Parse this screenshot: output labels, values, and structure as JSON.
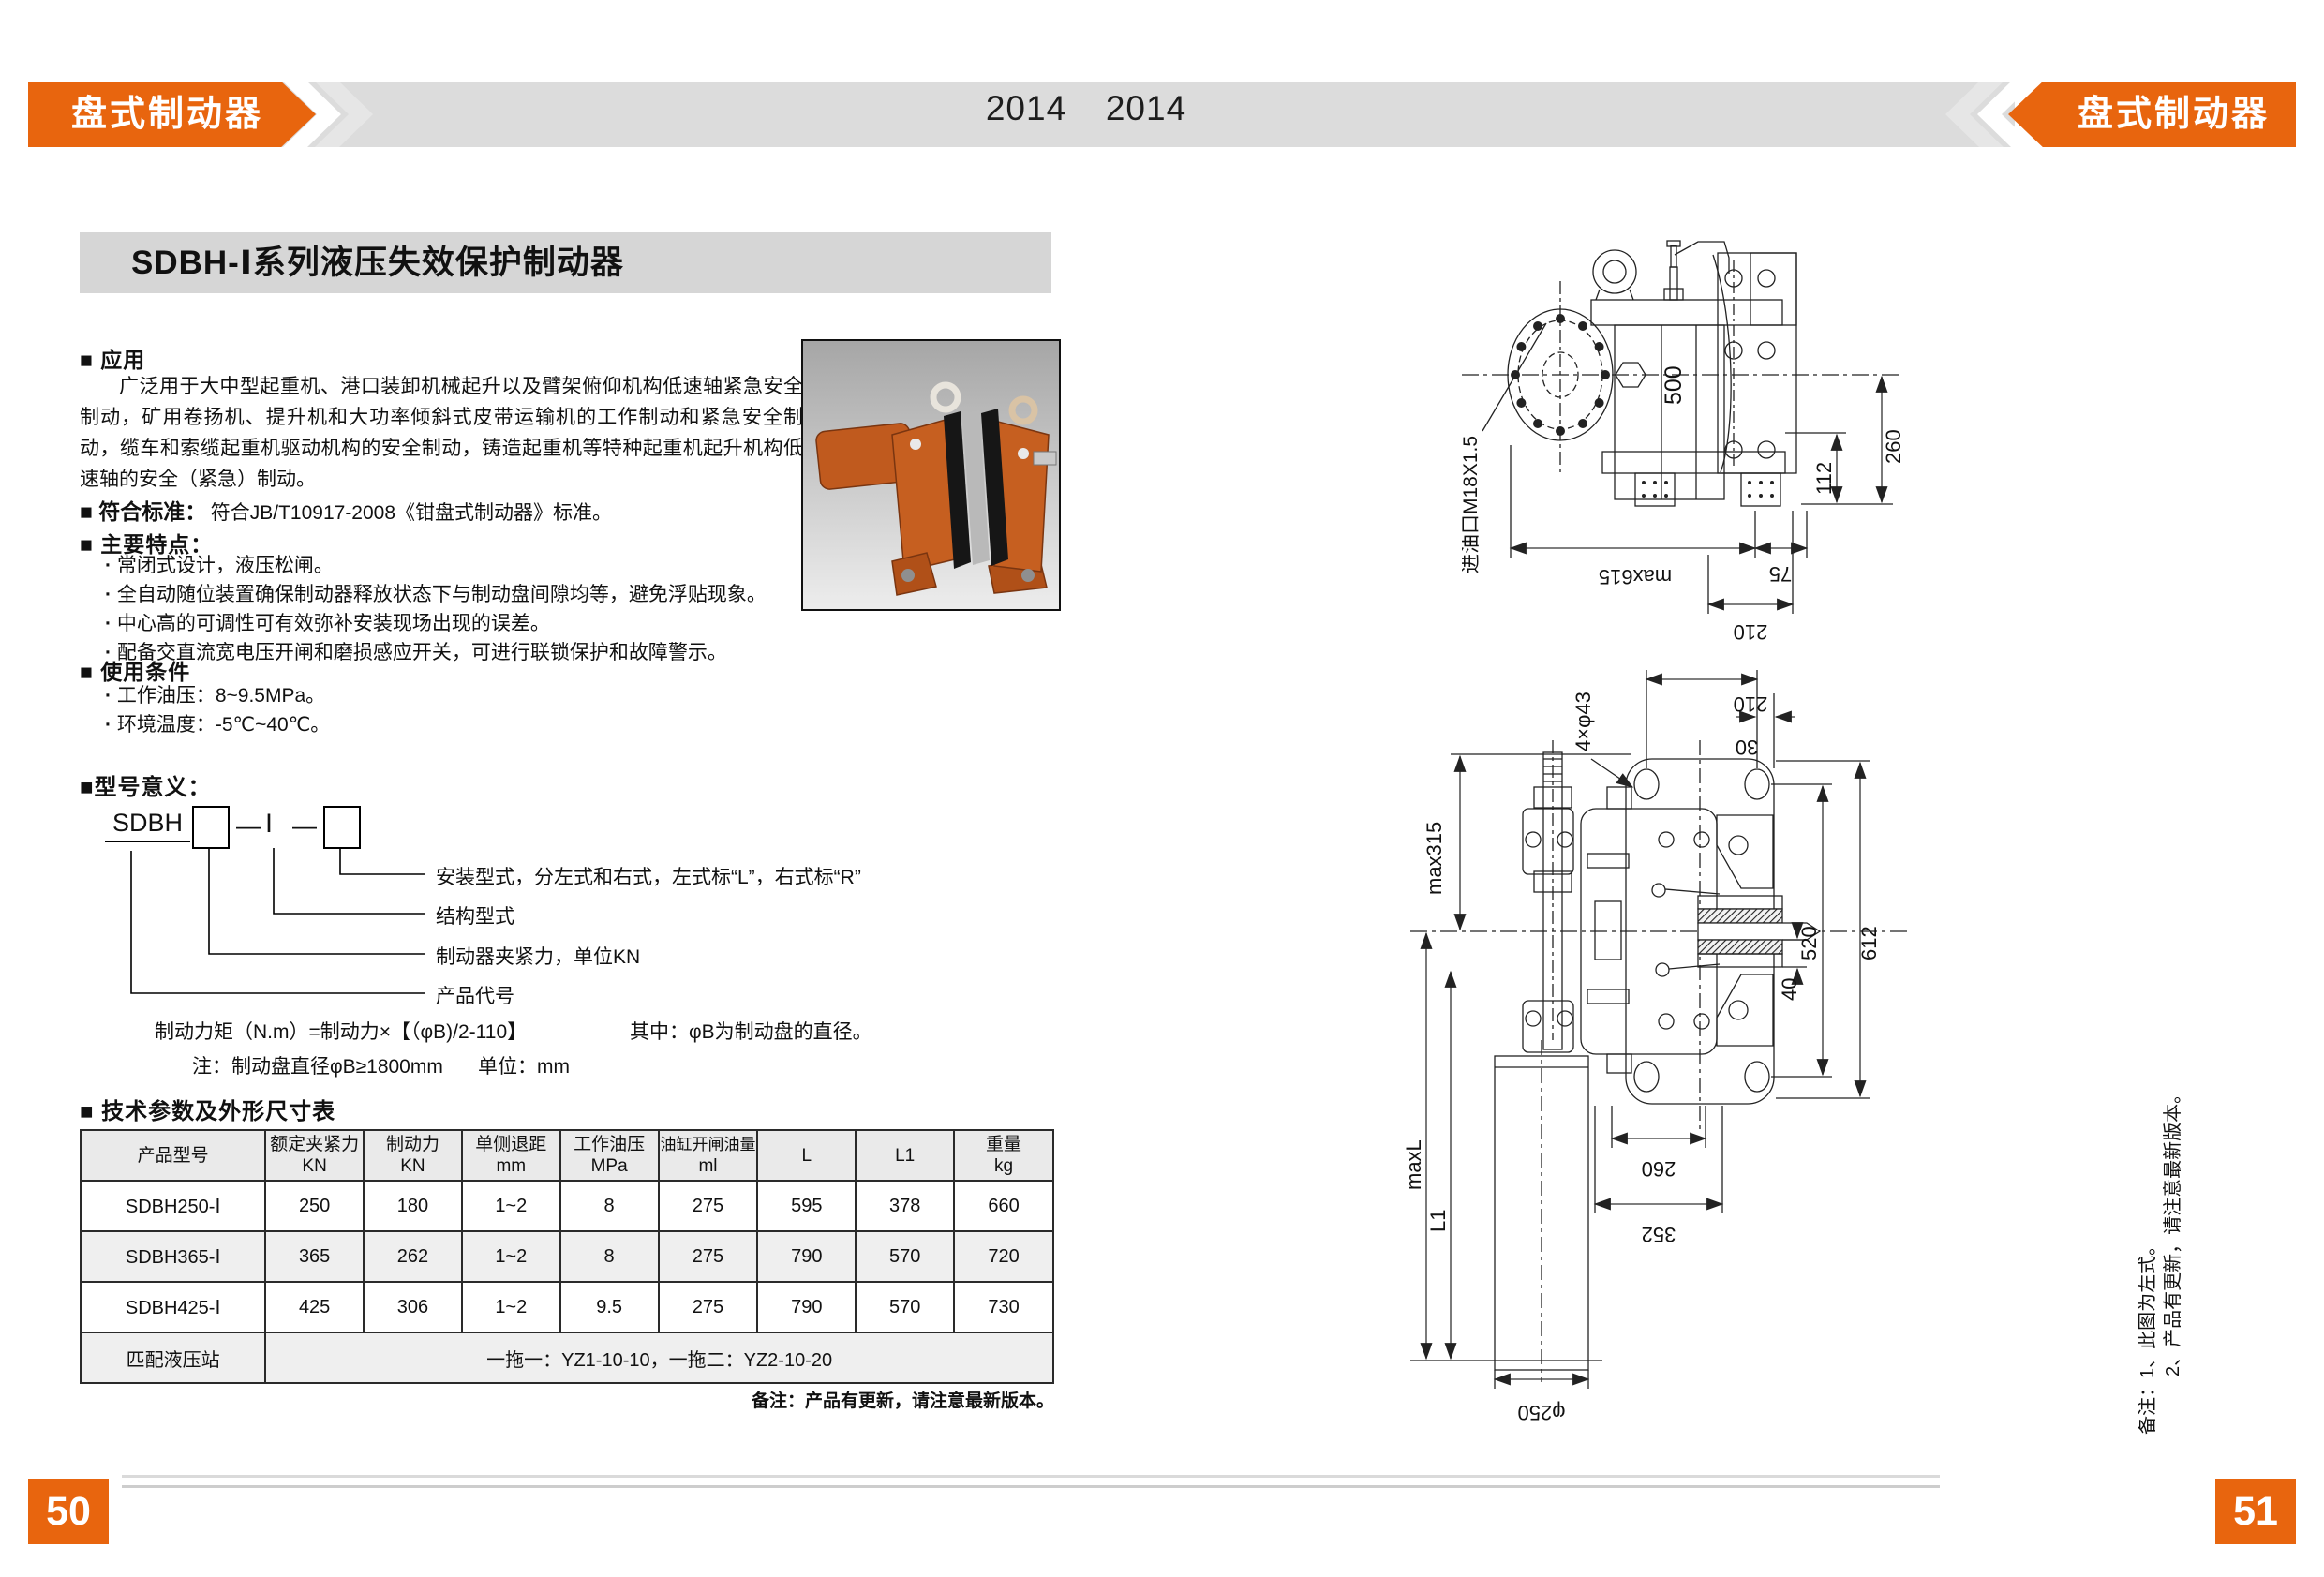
{
  "colors": {
    "accent": "#E8650E",
    "band": "#DCDCDC",
    "titlebar": "#D6D6D6"
  },
  "header": {
    "banner_left": "盘式制动器",
    "banner_right": "盘式制动器",
    "year_a": "2014",
    "year_b": "2014"
  },
  "titlebar": "SDBH-Ⅰ系列液压失效保护制动器",
  "application": {
    "heading": "■ 应用",
    "body": "广泛用于大中型起重机、港口装卸机械起升以及臂架俯仰机构低速轴紧急安全制动，矿用卷扬机、提升机和大功率倾斜式皮带运输机的工作制动和紧急安全制动，缆车和索缆起重机驱动机构的安全制动，铸造起重机等特种起重机起升机构低速轴的安全（紧急）制动。"
  },
  "standard": {
    "heading": "■ 符合标准：",
    "body": "符合JB/T10917-2008《钳盘式制动器》标准。"
  },
  "features": {
    "heading": "■ 主要特点：",
    "items": [
      "常闭式设计，液压松闸。",
      "全自动随位装置确保制动器释放状态下与制动盘间隙均等，避免浮贴现象。",
      "中心高的可调性可有效弥补安装现场出现的误差。",
      "配备交直流宽电压开闸和磨损感应开关，可进行联锁保护和故障警示。"
    ]
  },
  "conditions": {
    "heading": "■ 使用条件",
    "items": [
      "工作油压：8~9.5MPa。",
      "环境温度：-5℃~40℃。"
    ]
  },
  "model": {
    "heading": "■型号意义：",
    "prefix": "SDBH",
    "dash": "—",
    "series": "Ⅰ",
    "labels": [
      "安装型式，分左式和右式，左式标“L”，右式标“R”",
      "结构型式",
      "制动器夹紧力，单位KN",
      "产品代号"
    ],
    "formula": "制动力矩（N.m）=制动力×【（φB)/2-110】",
    "formula_where": "其中：φB为制动盘的直径。",
    "note": "注：制动盘直径φB≥1800mm",
    "unit": "单位：mm"
  },
  "specs": {
    "heading": "■ 技术参数及外形尺寸表",
    "headers": [
      {
        "t": "产品型号",
        "u": ""
      },
      {
        "t": "额定夹紧力",
        "u": "KN"
      },
      {
        "t": "制动力",
        "u": "KN"
      },
      {
        "t": "单侧退距",
        "u": "mm"
      },
      {
        "t": "工作油压",
        "u": "MPa"
      },
      {
        "t": "油缸开闸油量",
        "u": "ml"
      },
      {
        "t": "L",
        "u": ""
      },
      {
        "t": "L1",
        "u": ""
      },
      {
        "t": "重量",
        "u": "kg"
      }
    ],
    "rows": [
      [
        "SDBH250-Ⅰ",
        "250",
        "180",
        "1~2",
        "8",
        "275",
        "595",
        "378",
        "660"
      ],
      [
        "SDBH365-Ⅰ",
        "365",
        "262",
        "1~2",
        "8",
        "275",
        "790",
        "570",
        "720"
      ],
      [
        "SDBH425-Ⅰ",
        "425",
        "306",
        "1~2",
        "9.5",
        "275",
        "790",
        "570",
        "730"
      ]
    ],
    "station_label": "匹配液压站",
    "station_value": "一拖一：YZ1-10-10，一拖二：YZ2-10-20",
    "note": "备注：产品有更新，请注意最新版本。"
  },
  "drawing_top": {
    "inlet": "进油口M18X1.5",
    "d500": "500",
    "d260": "260",
    "d112": "112",
    "dmax615": "max615",
    "d75": "75",
    "d210": "210"
  },
  "drawing_bottom": {
    "bolts": "4×φ43",
    "max315": "max315",
    "d210": "210",
    "d30": "30",
    "d520": "520",
    "d612": "612",
    "d40": "40",
    "maxL": "maxL",
    "l1": "L1",
    "d260": "260",
    "d352": "352",
    "d250": "φ250"
  },
  "side_note": {
    "line1": "备注：1、此图为左式。",
    "line2": "2、产品有更新，请注意最新版本。"
  },
  "pages": {
    "left": "50",
    "right": "51"
  }
}
